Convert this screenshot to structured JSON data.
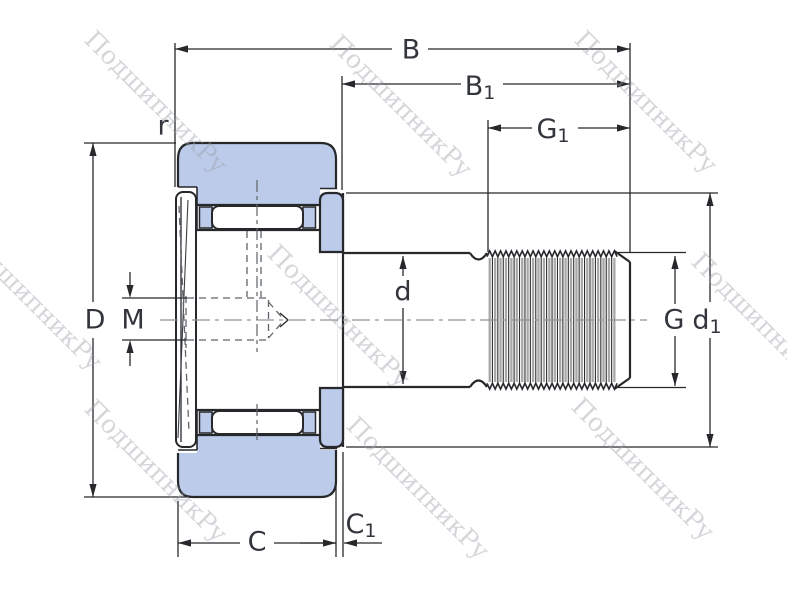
{
  "watermark": {
    "text": "ПодшипникРу"
  },
  "drawing": {
    "description": "Cam follower (stud-type track roller) bearing cross-section engineering drawing",
    "accent_fill": "#bccbea",
    "line_color": "#26282b"
  },
  "labels": {
    "B": "B",
    "B1": {
      "base": "B",
      "sub": "1"
    },
    "G1": {
      "base": "G",
      "sub": "1"
    },
    "r": "r",
    "D": "D",
    "M": "M",
    "d": "d",
    "G": "G",
    "d1": {
      "base": "d",
      "sub": "1"
    },
    "C": "C",
    "C1": {
      "base": "C",
      "sub": "1"
    }
  }
}
